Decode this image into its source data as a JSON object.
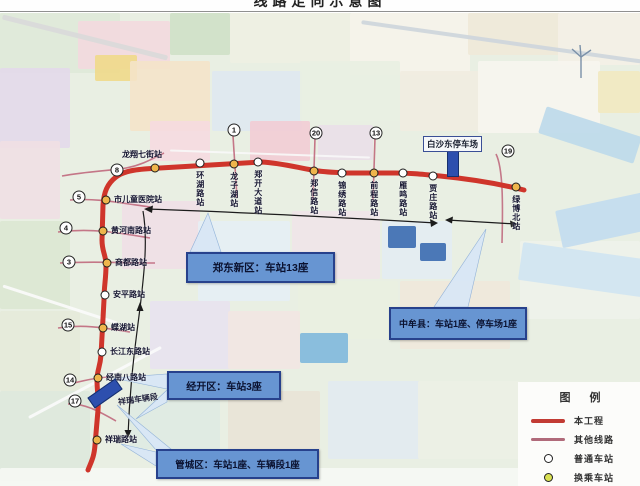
{
  "title_fragment": "线路走向示意图",
  "map": {
    "callouts": {
      "zhengdong": {
        "text": "郑东新区：车站13座"
      },
      "zhongmou": {
        "text": "中牟县：车站1座、停车场1座"
      },
      "jingkai": {
        "text": "经开区：车站3座"
      },
      "guancheng": {
        "text": "管城区：车站1座、车辆段1座"
      }
    },
    "parking_label": "白沙东停车场",
    "depot_label": "祥瑞车辆段",
    "stations": [
      {
        "name": "龙翔七街站",
        "type": "transfer",
        "x": 155,
        "y": 168,
        "lab": "ha"
      },
      {
        "name": "环湖路站",
        "type": "normal",
        "x": 200,
        "y": 163,
        "lab": "v"
      },
      {
        "name": "龙子湖站",
        "type": "transfer",
        "x": 234,
        "y": 164,
        "lab": "v"
      },
      {
        "name": "郑开大道站",
        "type": "normal",
        "x": 258,
        "y": 162,
        "lab": "v"
      },
      {
        "name": "郑信路站",
        "type": "transfer",
        "x": 314,
        "y": 171,
        "lab": "v"
      },
      {
        "name": "锦绣路站",
        "type": "normal",
        "x": 342,
        "y": 173,
        "lab": "v"
      },
      {
        "name": "前程路站",
        "type": "transfer",
        "x": 374,
        "y": 173,
        "lab": "v"
      },
      {
        "name": "雁鸣路站",
        "type": "normal",
        "x": 403,
        "y": 173,
        "lab": "v"
      },
      {
        "name": "贾庄路站",
        "type": "normal",
        "x": 433,
        "y": 176,
        "lab": "v"
      },
      {
        "name": "绿博北站",
        "type": "transfer",
        "x": 516,
        "y": 187,
        "lab": "v"
      },
      {
        "name": "市儿童医院站",
        "type": "transfer",
        "x": 106,
        "y": 200,
        "lab": "h"
      },
      {
        "name": "黄河南路站",
        "type": "transfer",
        "x": 103,
        "y": 231,
        "lab": "h"
      },
      {
        "name": "商都路站",
        "type": "transfer",
        "x": 107,
        "y": 263,
        "lab": "h"
      },
      {
        "name": "安平路站",
        "type": "normal",
        "x": 105,
        "y": 295,
        "lab": "h"
      },
      {
        "name": "蝶湖站",
        "type": "transfer",
        "x": 103,
        "y": 328,
        "lab": "h"
      },
      {
        "name": "长江东路站",
        "type": "normal",
        "x": 102,
        "y": 352,
        "lab": "h"
      },
      {
        "name": "经南八路站",
        "type": "transfer",
        "x": 98,
        "y": 378,
        "lab": "h"
      },
      {
        "name": "祥瑞路站",
        "type": "transfer",
        "x": 97,
        "y": 440,
        "lab": "h"
      }
    ],
    "line_badges": [
      {
        "line": "8",
        "x": 117,
        "y": 170
      },
      {
        "line": "1",
        "x": 234,
        "y": 130
      },
      {
        "line": "20",
        "x": 316,
        "y": 133
      },
      {
        "line": "13",
        "x": 376,
        "y": 133
      },
      {
        "line": "19",
        "x": 508,
        "y": 151
      },
      {
        "line": "5",
        "x": 79,
        "y": 197
      },
      {
        "line": "4",
        "x": 66,
        "y": 228
      },
      {
        "line": "3",
        "x": 69,
        "y": 262
      },
      {
        "line": "15",
        "x": 68,
        "y": 325
      },
      {
        "line": "14",
        "x": 70,
        "y": 380
      },
      {
        "line": "17",
        "x": 75,
        "y": 401
      }
    ]
  },
  "legend": {
    "header": "图 例",
    "items": [
      {
        "label": "本工程",
        "swatch": "line-thick",
        "color": "#c23b33"
      },
      {
        "label": "其他线路",
        "swatch": "line-thin",
        "color": "#b06a7a"
      },
      {
        "label": "普通车站",
        "swatch": "circle",
        "color": "#ffffff"
      },
      {
        "label": "换乘车站",
        "swatch": "circle",
        "color": "#d9e052"
      }
    ]
  }
}
